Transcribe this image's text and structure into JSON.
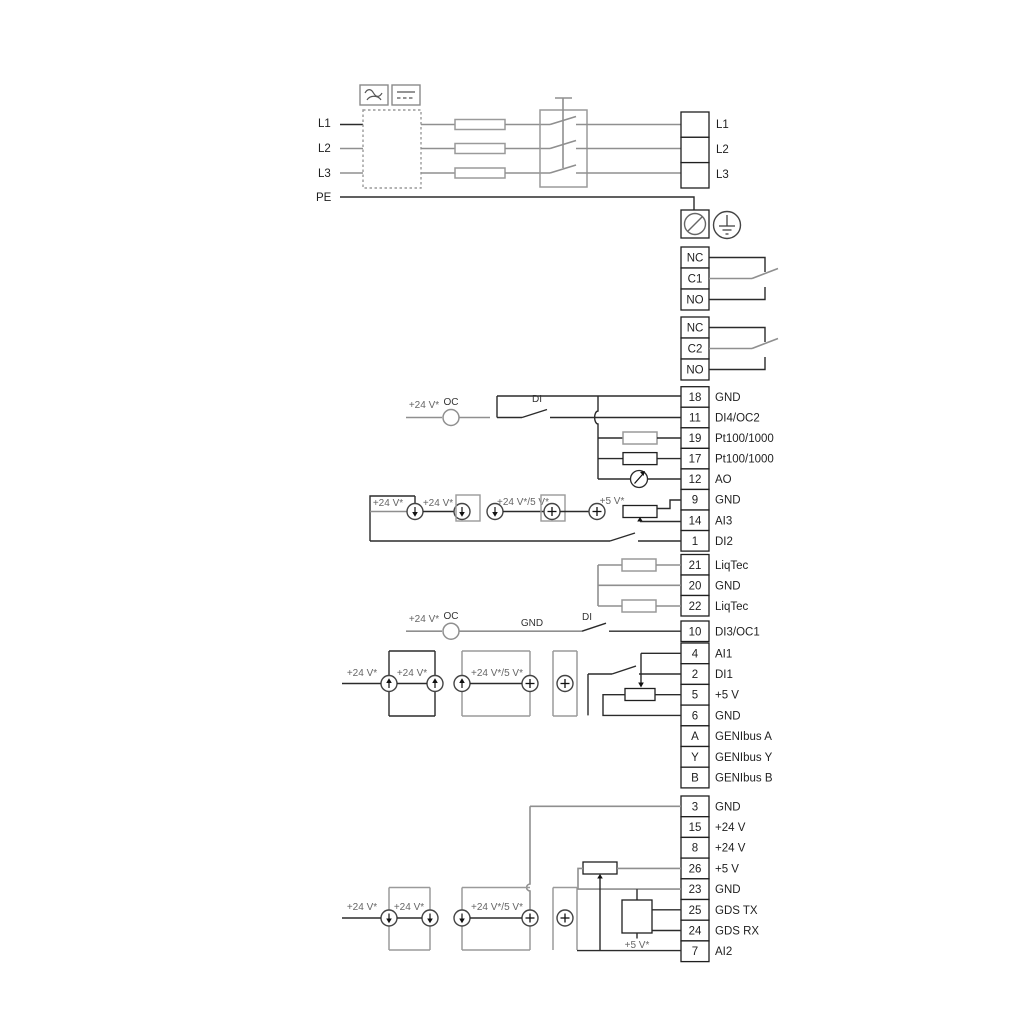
{
  "diagram_title": "Drive wiring and terminal connection diagram",
  "power": {
    "left": [
      "L1",
      "L2",
      "L3",
      "PE"
    ],
    "right": [
      "L1",
      "L2",
      "L3"
    ]
  },
  "relay1": {
    "rows": [
      "NC",
      "C1",
      "NO"
    ]
  },
  "relay2": {
    "rows": [
      "NC",
      "C2",
      "NO"
    ]
  },
  "io": {
    "rows": [
      {
        "n": "18",
        "label": "GND"
      },
      {
        "n": "11",
        "label": "DI4/OC2"
      },
      {
        "n": "19",
        "label": "Pt100/1000"
      },
      {
        "n": "17",
        "label": "Pt100/1000"
      },
      {
        "n": "12",
        "label": "AO"
      },
      {
        "n": "9",
        "label": "GND"
      },
      {
        "n": "14",
        "label": "AI3"
      },
      {
        "n": "1",
        "label": "DI2"
      }
    ]
  },
  "liqtec": {
    "rows": [
      {
        "n": "21",
        "label": "LiqTec"
      },
      {
        "n": "20",
        "label": "GND"
      },
      {
        "n": "22",
        "label": "LiqTec"
      }
    ]
  },
  "di3": {
    "n": "10",
    "label": "DI3/OC1"
  },
  "comm": {
    "rows": [
      {
        "n": "4",
        "label": "AI1"
      },
      {
        "n": "2",
        "label": "DI1"
      },
      {
        "n": "5",
        "label": "+5 V"
      },
      {
        "n": "6",
        "label": "GND"
      },
      {
        "n": "A",
        "label": "GENIbus A"
      },
      {
        "n": "Y",
        "label": "GENIbus Y"
      },
      {
        "n": "B",
        "label": "GENIbus B"
      }
    ]
  },
  "bottom": {
    "rows": [
      {
        "n": "3",
        "label": "GND"
      },
      {
        "n": "15",
        "label": "+24 V"
      },
      {
        "n": "8",
        "label": "+24 V"
      },
      {
        "n": "26",
        "label": "+5 V"
      },
      {
        "n": "23",
        "label": "GND"
      },
      {
        "n": "25",
        "label": "GDS TX"
      },
      {
        "n": "24",
        "label": "GDS RX"
      },
      {
        "n": "7",
        "label": "AI2"
      }
    ]
  },
  "ann": {
    "p24": "+24 V*",
    "oc": "OC",
    "di": "DI",
    "gnd": "GND",
    "p24_5": "+24 V*/5 V*",
    "p5": "+5 V*"
  },
  "colors": {
    "wire_gray": "#8f8f8f",
    "wire_dark": "#2b2b2b",
    "text": "#1f1f1f"
  }
}
